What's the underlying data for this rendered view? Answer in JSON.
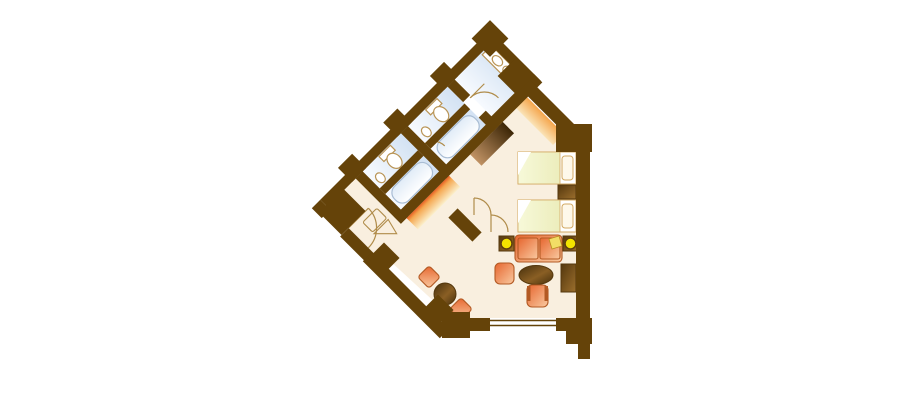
{
  "meta": {
    "title": "hotel-suite-floor-plan",
    "canvas": {
      "width": 910,
      "height": 400,
      "background": "#ffffff"
    }
  },
  "palette": {
    "wall": "#654309",
    "floor": "#F9EFDF",
    "bath_floor_blue": "#D3E2F3",
    "bath_floor_light": "#F7FAFE",
    "tub_blue": "#E0EBF7",
    "tub_light": "#FFFFFF",
    "tub_stroke": "#A9BDD4",
    "fixture_fill": "#FFFFFF",
    "fixture_stroke": "#B99455",
    "door_stroke": "#B08C4A",
    "bed_base": "#FFFFFF",
    "blanket_1": "#F7F9D9",
    "blanket_2": "#ECEDBC",
    "fold_white": "#FFFFFF",
    "pillow_fill": "#FEF8EA",
    "pillow_stroke": "#D3A963",
    "cushion_1": "#E6662F",
    "cushion_2": "#F9C9A0",
    "furniture_outline": "#B35A24",
    "wood_dark": "#54370D",
    "wood_mid": "#7B5419",
    "wood_light": "#9C6F2D",
    "table_dark": "#47300C",
    "table_light": "#8A5F24",
    "lamp_yellow": "#F4E400",
    "lamp_ring": "#5E3E0E",
    "throw_yellow": "#F2DD66",
    "throw_edge": "#B98A1F",
    "closet_orange_edge": "#E95F24",
    "closet_orange_mid": "#F5A74F",
    "closet_orange_pale": "#FBEFCB",
    "closet_brown_dark": "#3C2606",
    "closet_brown_light": "#C09264"
  },
  "floorplan": {
    "rooms": [
      {
        "name": "bedroom"
      },
      {
        "name": "vanity-room-double-sink"
      },
      {
        "name": "wc-room-1"
      },
      {
        "name": "bathtub-room-1"
      },
      {
        "name": "wc-room-2"
      },
      {
        "name": "bathtub-room-2"
      },
      {
        "name": "entry-corridor"
      }
    ],
    "furniture": [
      {
        "name": "twin-bed",
        "count": 2
      },
      {
        "name": "pillow",
        "count": 2
      },
      {
        "name": "nightstand",
        "count": 1
      },
      {
        "name": "sofa-two-seat",
        "count": 1
      },
      {
        "name": "end-table-with-lamp",
        "count": 2
      },
      {
        "name": "armchair",
        "count": 1
      },
      {
        "name": "lounge-chair",
        "count": 1
      },
      {
        "name": "coffee-table-oval",
        "count": 1
      },
      {
        "name": "tv-cabinet",
        "count": 1
      },
      {
        "name": "dining-chair",
        "count": 2
      },
      {
        "name": "dining-table",
        "count": 1
      },
      {
        "name": "luggage-rack",
        "count": 1
      },
      {
        "name": "closet-band-orange",
        "count": 2
      },
      {
        "name": "closet-band-brown",
        "count": 1
      }
    ],
    "fixtures": [
      {
        "name": "double-vanity-sink",
        "count": 1
      },
      {
        "name": "toilet",
        "count": 2
      },
      {
        "name": "hand-basin",
        "count": 2
      },
      {
        "name": "bathtub",
        "count": 2
      },
      {
        "name": "entry-door",
        "count": 1
      },
      {
        "name": "interior-door",
        "count": 2
      },
      {
        "name": "double-door",
        "count": 1
      },
      {
        "name": "window",
        "count": 1
      }
    ]
  }
}
